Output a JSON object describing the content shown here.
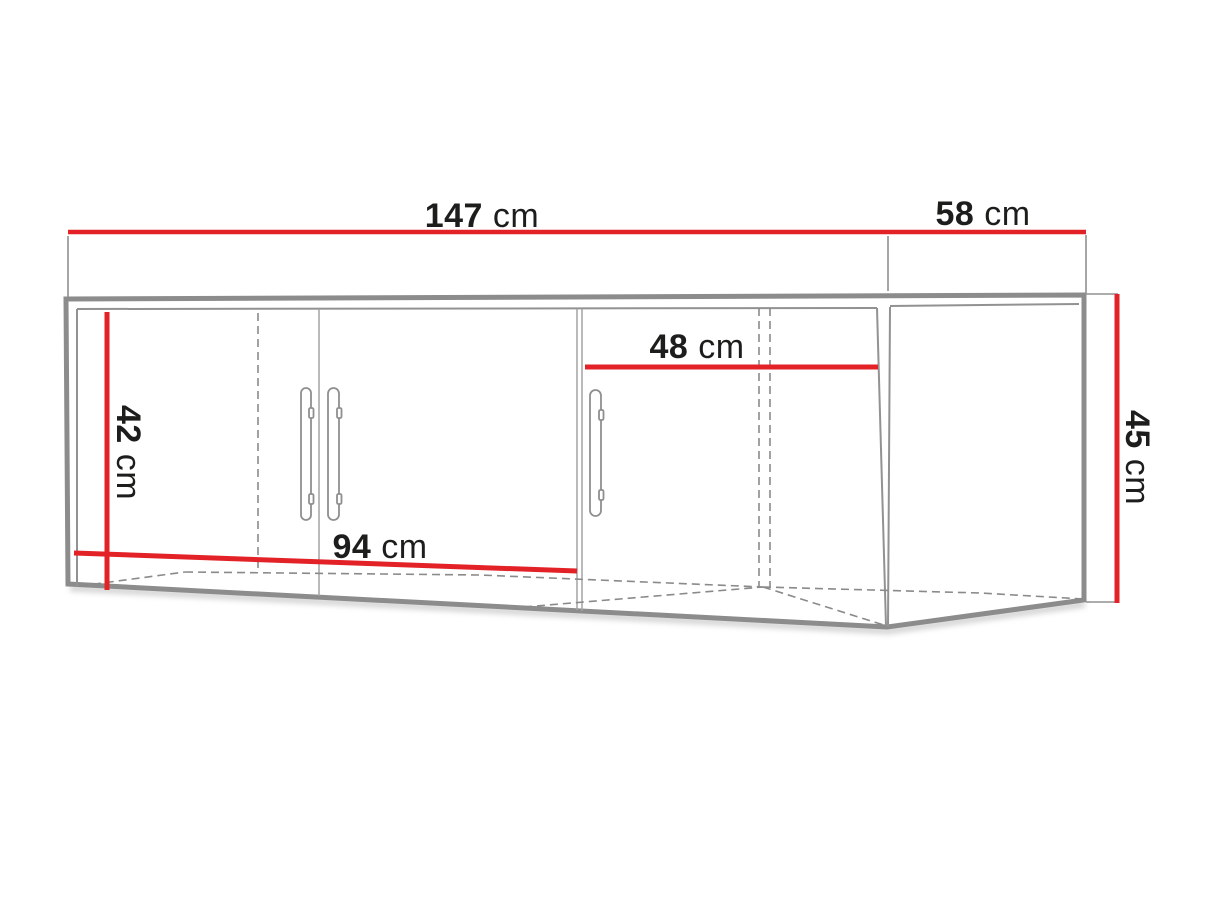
{
  "diagram": {
    "type": "furniture-dimension-drawing",
    "dimensions": {
      "front_width": {
        "value": "147",
        "unit": "cm"
      },
      "side_depth": {
        "value": "58",
        "unit": "cm"
      },
      "right_door_width": {
        "value": "48",
        "unit": "cm"
      },
      "interior_height": {
        "value": "42",
        "unit": "cm"
      },
      "overall_height": {
        "value": "45",
        "unit": "cm"
      },
      "double_door_width": {
        "value": "94",
        "unit": "cm"
      }
    },
    "colors": {
      "dimension_line": "#e32227",
      "outline_thick": "#8c8c8c",
      "outline_thin": "#999999",
      "hidden_line": "#8a8a8a",
      "text": "#1d1d1b",
      "background": "#ffffff"
    }
  }
}
